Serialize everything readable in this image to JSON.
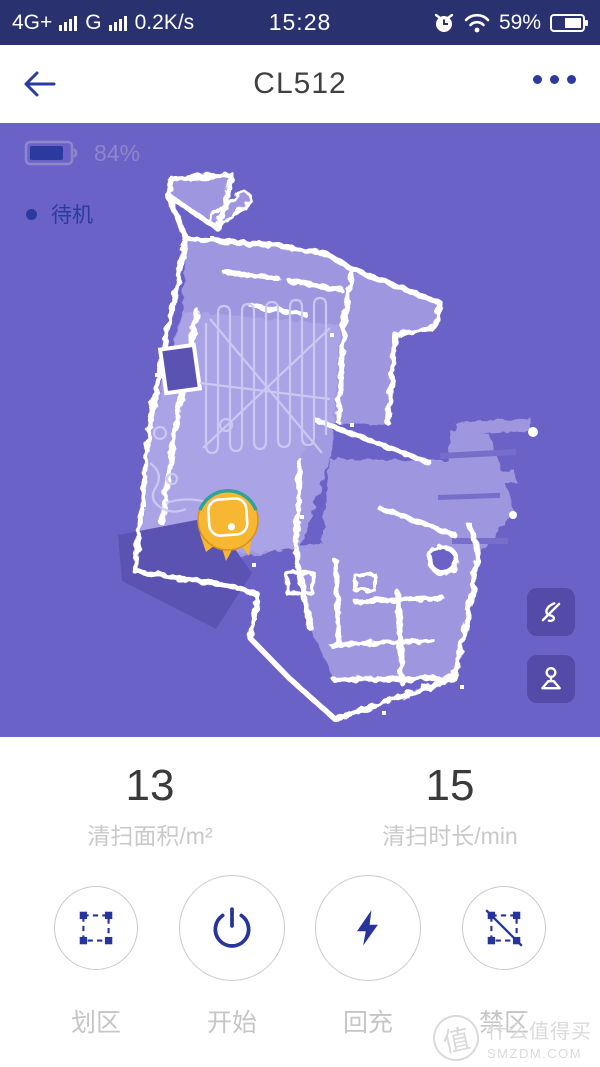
{
  "status_bar": {
    "network_primary": "4G+",
    "network_secondary": "G",
    "data_rate": "0.2K/s",
    "time": "15:28",
    "battery_percent": "59%"
  },
  "header": {
    "title": "CL512"
  },
  "map": {
    "battery_percent": "84%",
    "status_label": "待机"
  },
  "stats": {
    "area": {
      "value": "13",
      "label": "清扫面积/m²"
    },
    "duration": {
      "value": "15",
      "label": "清扫时长/min"
    }
  },
  "actions": [
    {
      "id": "zone",
      "label": "划区"
    },
    {
      "id": "start",
      "label": "开始"
    },
    {
      "id": "recharge",
      "label": "回充"
    },
    {
      "id": "forbidden-zone",
      "label": "禁区"
    }
  ],
  "watermark": {
    "logo_char": "值",
    "name": "什么值得买",
    "site": "SMZDM.COM"
  },
  "colors": {
    "accent_navy": "#2B3A9E",
    "status_bar_bg": "#2A316F",
    "map_background": "#6A62C6",
    "floor": "#9E97DF",
    "floor_traced": "#ACA5E7",
    "wall": "#FFFFFF",
    "dark_patch": "#5B53B2",
    "map_button_bg": "#544BA9",
    "robot_yellow": "#F7B733",
    "muted_text": "#C9C9C9"
  }
}
